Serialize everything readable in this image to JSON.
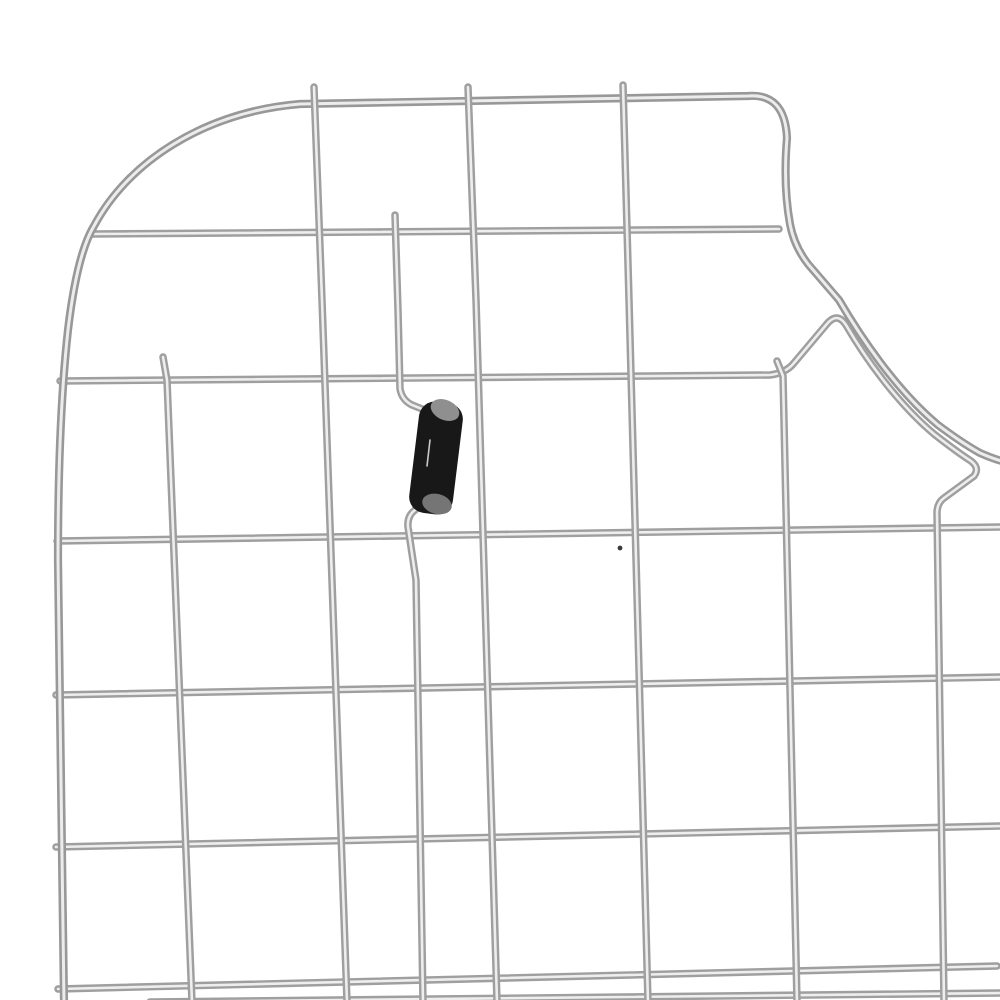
{
  "meta": {
    "subject": "stainless-steel-sink-bottom-grid",
    "description": "Close-up product photo of a chrome wire sink grid with rounded top-left corner, right-side drain cutout curve, and one black rubber bumper foot",
    "background_color": "#ffffff"
  },
  "canvas": {
    "width": 1000,
    "height": 1000
  },
  "palette": {
    "wire_edge": "#9f9f9f",
    "wire_core": "#eeeeee",
    "rim_edge": "#989898",
    "rim_core": "#ececec",
    "bumper_body": "#181818",
    "bumper_cap_top": "#8f8f8f",
    "bumper_cap_bottom": "#757575",
    "bumper_glint": "#c9c9c9",
    "dust_speck": "#3a3a3a"
  },
  "wire_style": {
    "base_width": 7.5,
    "core_width": 2.6,
    "rim_base_width": 8.2,
    "rim_core_width": 3.0
  },
  "wires": [
    {
      "name": "grid-horizontal-wire-2",
      "kind": "grid",
      "d": "M 92 234 L 779 229"
    },
    {
      "name": "grid-horizontal-wire-4",
      "kind": "grid",
      "d": "M 57 541 L 1002 527"
    },
    {
      "name": "grid-horizontal-wire-5",
      "kind": "grid",
      "d": "M 56 695 L 1002 677"
    },
    {
      "name": "grid-horizontal-wire-6",
      "kind": "grid",
      "d": "M 56 847 L 1002 826"
    },
    {
      "name": "grid-horizontal-wire-7",
      "kind": "grid",
      "d": "M 58 989 L 997 966"
    },
    {
      "name": "grid-horizontal-wire-8-partial",
      "kind": "grid",
      "d": "M 150 1002 L 1002 993"
    },
    {
      "name": "cutout-contour-wire",
      "kind": "grid",
      "d": "M 60 381 L 770 375 Q 786 373 794 363 L 826 325 Q 837 311 846 325 C 864 356 896 402 934 434 Q 957 452 971 461 Q 980 468 974 476 L 944 498 Q 937 503 937 513 L 944 1002"
    },
    {
      "name": "outer-rim-wire",
      "kind": "rim",
      "d": "M 64 1002 L 58 560 Q 58 420 68 330 Q 77 254 94 226 C 128 162 204 112 300 104 L 748 96 Q 785 93 787 138 Q 783 185 790 224 Q 794 246 808 264 L 839 300 C 860 336 896 390 938 425 Q 962 443 980 453 Q 996 460 1006 462"
    },
    {
      "name": "grid-vertical-wire-1",
      "kind": "grid",
      "d": "M 163 357 L 167 380 L 192 1002"
    },
    {
      "name": "grid-vertical-wire-2",
      "kind": "grid",
      "d": "M 314 87 L 322 300 L 347 1002"
    },
    {
      "name": "grid-vertical-wire-3",
      "kind": "grid",
      "d": "M 468 87 L 476 300 L 497 1002"
    },
    {
      "name": "grid-vertical-wire-4",
      "kind": "grid",
      "d": "M 623 85 L 629 300 L 648 1002"
    },
    {
      "name": "bumper-hook-wire",
      "kind": "grid",
      "d": "M 395 215 L 398 310 L 400 389 Q 402 400 412 405 L 437 415 Q 447 420 446 433 L 443 477 Q 442 491 433 497 L 415 510 Q 407 516 408 527 L 416 580 L 423 1002"
    },
    {
      "name": "grid-vertical-wire-5",
      "kind": "grid",
      "d": "M 777 361 L 783 376 L 797 1002"
    }
  ],
  "bumper": {
    "name": "rubber-bumper-foot",
    "body": {
      "x": 414,
      "y": 402,
      "width": 44,
      "height": 112,
      "rx": 16,
      "rotate": 7,
      "cx": 436,
      "cy": 458
    },
    "cap_top": {
      "cx": 445,
      "cy": 410,
      "rx": 15,
      "ry": 10,
      "rotate": 24
    },
    "cap_bottom": {
      "cx": 437,
      "cy": 504,
      "rx": 15,
      "ry": 10,
      "rotate": 14
    },
    "glint": {
      "x1": 430,
      "y1": 440,
      "x2": 427,
      "y2": 466
    }
  },
  "speck": {
    "name": "dust-speck",
    "cx": 620,
    "cy": 548,
    "r": 2.4
  }
}
